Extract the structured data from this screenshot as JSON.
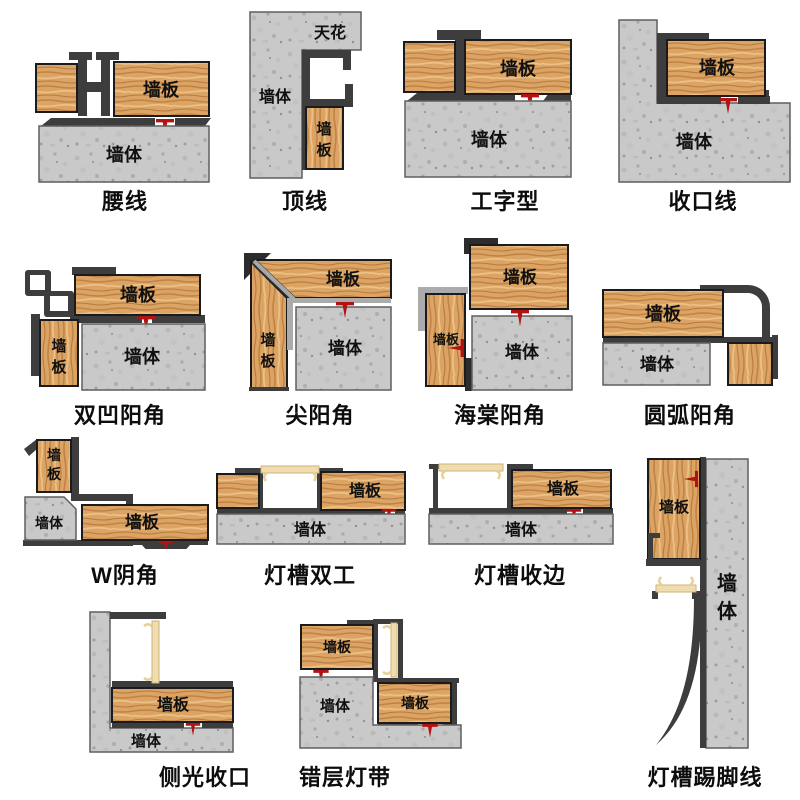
{
  "page": {
    "background": "#ffffff"
  },
  "glyphs": {
    "panel": "墙板",
    "wall": "墙体",
    "ceiling": "天花",
    "panel_c1": "墙",
    "panel_c2": "板",
    "wall_c1": "墙",
    "wall_c2": "体"
  },
  "colors": {
    "profile_dark": "#3d3d3d",
    "wood_base": "#d9a263",
    "concrete_base": "#cacaca",
    "glue_red": "#b11212",
    "led_cream": "#efddb0"
  },
  "tiles": [
    {
      "id": "waistline",
      "caption": "腰线"
    },
    {
      "id": "crown-line",
      "caption": "顶线"
    },
    {
      "id": "i-shape",
      "caption": "工字型"
    },
    {
      "id": "closing-line",
      "caption": "收口线"
    },
    {
      "id": "double-concave-outer-corner",
      "caption": "双凹阳角"
    },
    {
      "id": "sharp-outer-corner",
      "caption": "尖阳角"
    },
    {
      "id": "begonia-outer-corner",
      "caption": "海棠阳角"
    },
    {
      "id": "arc-outer-corner",
      "caption": "圆弧阳角"
    },
    {
      "id": "w-inner-corner",
      "caption": "W阴角"
    },
    {
      "id": "light-trough-double",
      "caption": "灯槽双工"
    },
    {
      "id": "light-trough-edge",
      "caption": "灯槽收边"
    },
    {
      "id": "light-trough-skirting",
      "caption": "灯槽踢脚线"
    },
    {
      "id": "side-light-closing",
      "caption": "侧光收口"
    },
    {
      "id": "staggered-light-strip",
      "caption": "错层灯带"
    }
  ]
}
